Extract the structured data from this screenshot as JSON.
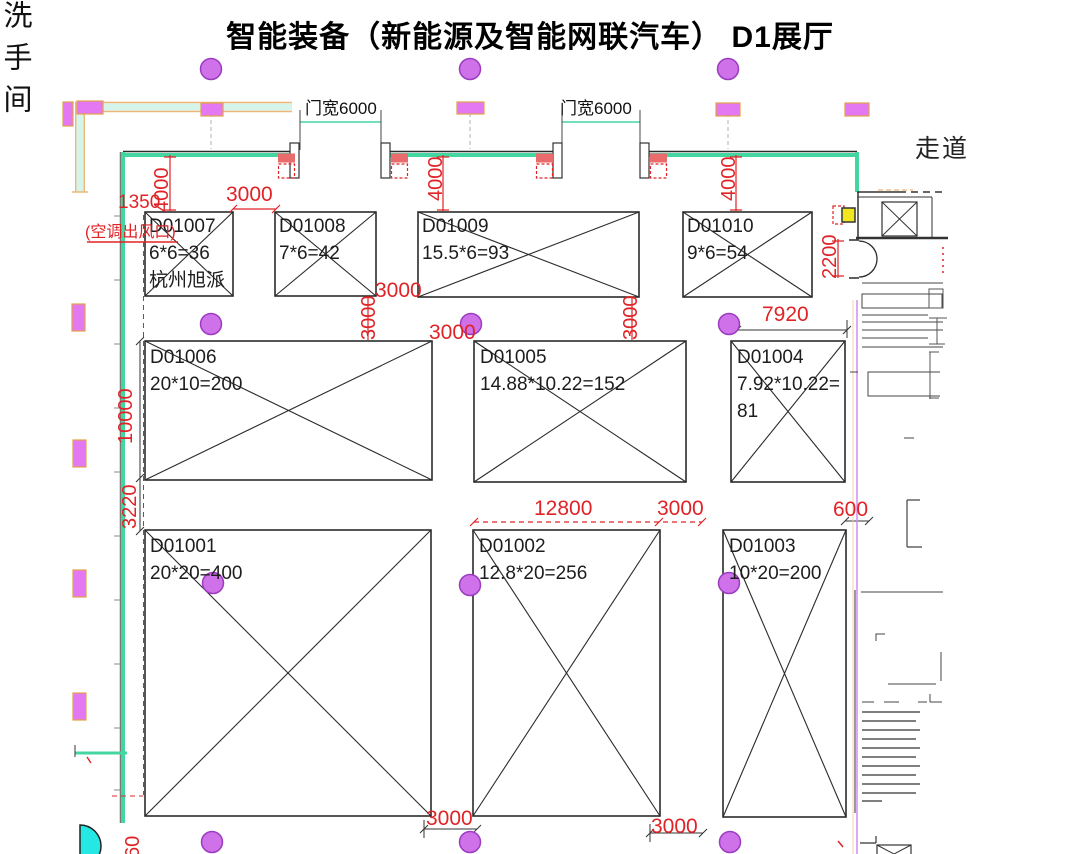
{
  "title": "智能装备（新能源及智能网联汽车）  D1展厅",
  "corridor_label": "走道",
  "restroom_label": "洗手间",
  "door_width_label": "门宽6000",
  "ac_outlet_label": "(空调出风口)",
  "booths": [
    {
      "id": "D01001",
      "area": "20*20=400"
    },
    {
      "id": "D01002",
      "area": "12.8*20=256"
    },
    {
      "id": "D01003",
      "area": "10*20=200"
    },
    {
      "id": "D01004",
      "area": "7.92*10.22=",
      "line3": "81"
    },
    {
      "id": "D01005",
      "area": "14.88*10.22=152"
    },
    {
      "id": "D01006",
      "area": "20*10=200"
    },
    {
      "id": "D01007",
      "area": "6*6=36",
      "line3": "杭州旭派"
    },
    {
      "id": "D01008",
      "area": "7*6=42"
    },
    {
      "id": "D01009",
      "area": "15.5*6=93"
    },
    {
      "id": "D01010",
      "area": "9*6=54"
    }
  ],
  "dims": {
    "v1350": "1350",
    "v4000": "4000",
    "v3000": "3000",
    "v2200": "2200",
    "v7920": "7920",
    "v10000": "10000",
    "v3220": "3220",
    "v12800": "12800",
    "v600": "600",
    "v60": "60"
  },
  "colors": {
    "dimension_red": "#e02326",
    "wall_green": "#43d6a0",
    "column_purple": "#cf72ea",
    "vent_magenta": "#e478f2",
    "accent_yellow": "#f2e71e",
    "accent_cyan": "#25e8e4"
  }
}
